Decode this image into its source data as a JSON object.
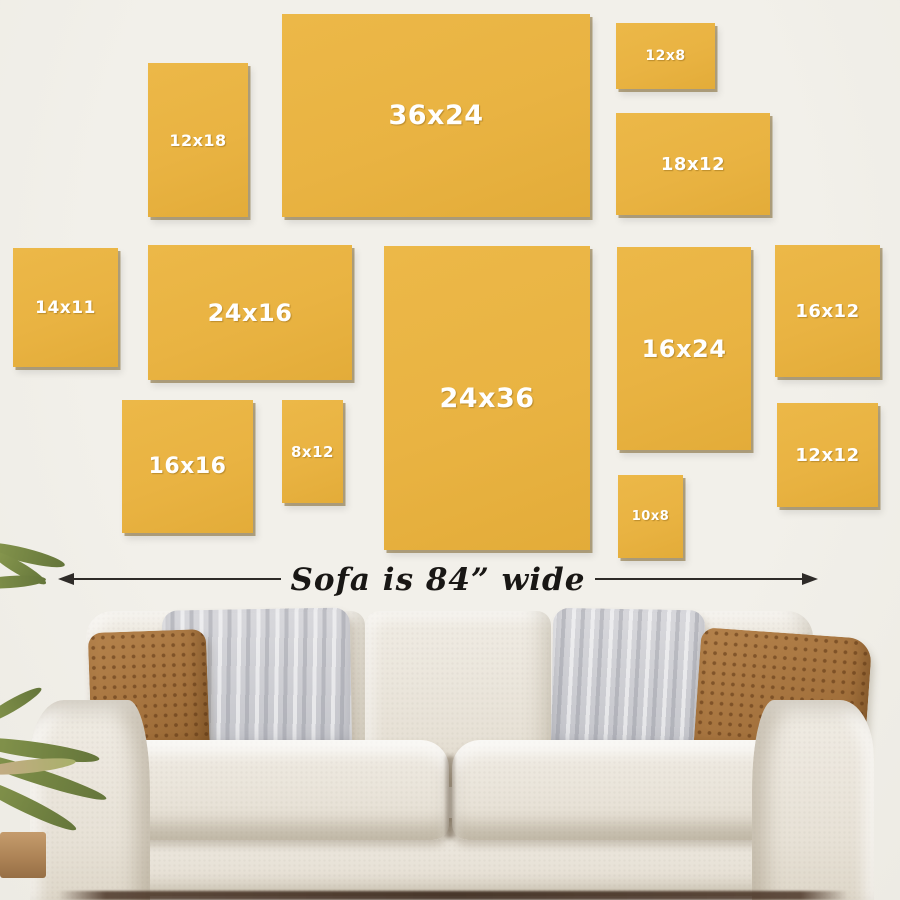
{
  "scene": {
    "wall_color": "#f0eee8",
    "floor_shadow_color": "#4a3426"
  },
  "frames": {
    "color": "#e9b342",
    "label_color": "#ffffff",
    "items": [
      {
        "label": "12x18",
        "x": 148,
        "y": 63,
        "w": 100,
        "h": 154,
        "fs": 16
      },
      {
        "label": "36x24",
        "x": 282,
        "y": 14,
        "w": 308,
        "h": 203,
        "fs": 27
      },
      {
        "label": "12x8",
        "x": 616,
        "y": 23,
        "w": 99,
        "h": 66,
        "fs": 14
      },
      {
        "label": "18x12",
        "x": 616,
        "y": 113,
        "w": 154,
        "h": 102,
        "fs": 18
      },
      {
        "label": "14x11",
        "x": 13,
        "y": 248,
        "w": 105,
        "h": 119,
        "fs": 17
      },
      {
        "label": "24x16",
        "x": 148,
        "y": 245,
        "w": 204,
        "h": 135,
        "fs": 24
      },
      {
        "label": "24x36",
        "x": 384,
        "y": 246,
        "w": 206,
        "h": 304,
        "fs": 27
      },
      {
        "label": "16x24",
        "x": 617,
        "y": 247,
        "w": 134,
        "h": 203,
        "fs": 24
      },
      {
        "label": "16x12",
        "x": 775,
        "y": 245,
        "w": 105,
        "h": 132,
        "fs": 18
      },
      {
        "label": "16x16",
        "x": 122,
        "y": 400,
        "w": 131,
        "h": 133,
        "fs": 22
      },
      {
        "label": "8x12",
        "x": 282,
        "y": 400,
        "w": 61,
        "h": 103,
        "fs": 15
      },
      {
        "label": "10x8",
        "x": 618,
        "y": 475,
        "w": 65,
        "h": 83,
        "fs": 13
      },
      {
        "label": "12x12",
        "x": 777,
        "y": 403,
        "w": 101,
        "h": 104,
        "fs": 18
      }
    ]
  },
  "arrow": {
    "label": "Sofa is 84” wide",
    "color": "#2e2b28"
  },
  "sofa": {
    "fabric_color": "#eae5dc",
    "pillow_brown_color": "#a5733e",
    "pillow_gray_color": "#cdced3"
  },
  "plant": {
    "leaf_color": "#75854a",
    "pot_color": "#b78d60"
  }
}
